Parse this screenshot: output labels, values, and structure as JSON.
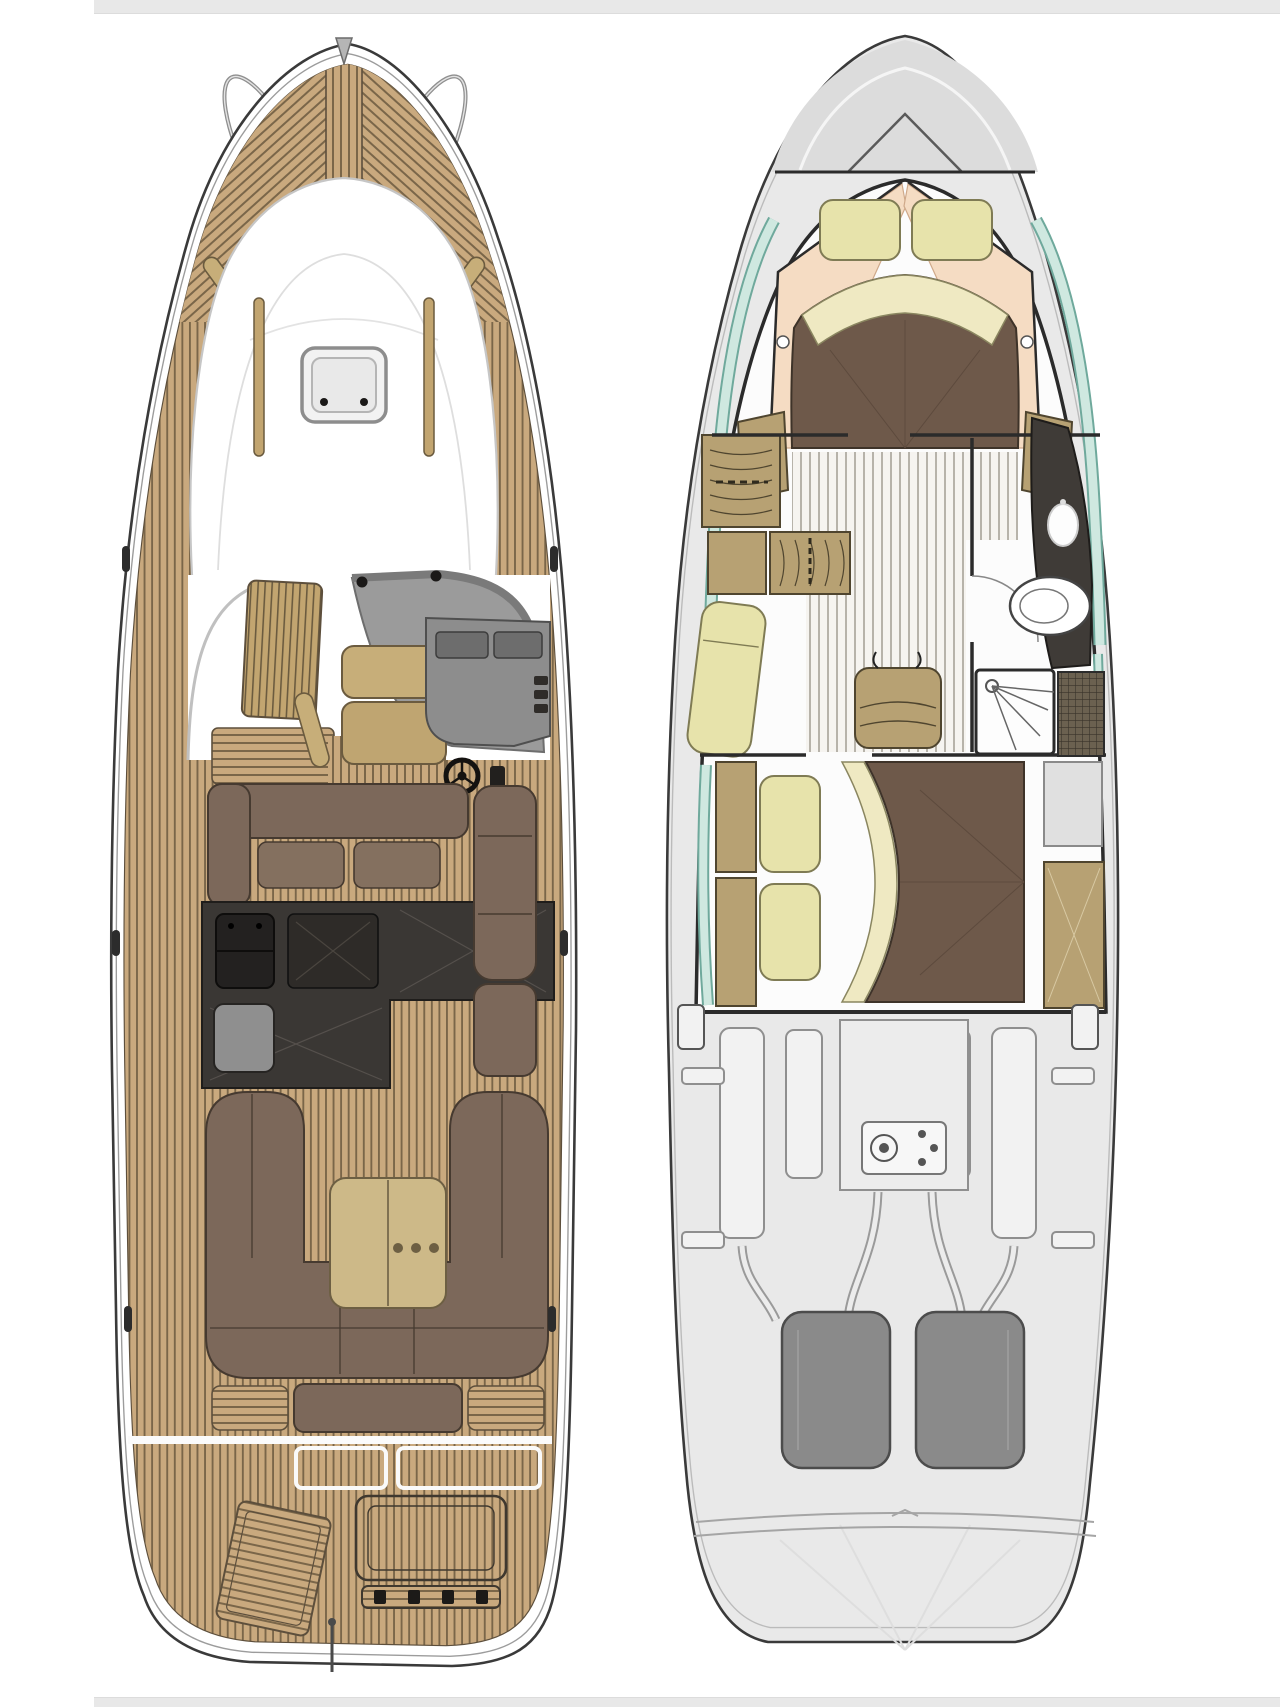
{
  "canvas": {
    "width": 1280,
    "height": 1707
  },
  "plans": [
    {
      "key": "main_deck",
      "semantic": "main-deck-floorplan",
      "features": [
        "bow-pulpit",
        "foredeck-sunpad",
        "roof-hatch",
        "windshield",
        "helm-console",
        "helm-seat",
        "salon-sofa",
        "galley",
        "cockpit-settee",
        "cockpit-table",
        "aft-sunpad",
        "swim-platform",
        "engine-hatch",
        "flag-pole"
      ]
    },
    {
      "key": "lower_deck",
      "semantic": "lower-deck-floorplan",
      "features": [
        "v-berth-bed",
        "pillows",
        "hull-windows",
        "wardrobe-lockers",
        "chaise-longue",
        "head-toilet",
        "shower-stall",
        "vanity",
        "aft-cabin-bed",
        "engine-room",
        "port-engine",
        "starboard-engine",
        "genset",
        "swim-platform"
      ]
    }
  ],
  "palette": {
    "page_bg": "#ffffff",
    "strip": "#e8e8e8",
    "outline": "#3a3a3a",
    "hull_inner_line": "#9c9c9c",
    "teak": "#c9a97e",
    "teak_line": "#7a6649",
    "teak_border": "#5d4f3c",
    "white_deck": "#ffffff",
    "deck_line": "#c6c6c6",
    "glass": "#9b9b9b",
    "glass_edge": "#6e6e6e",
    "windshield": "#7a7a7a",
    "black_dot": "#1b1918",
    "locker_tan": "#c2a570",
    "seat_tan": "#c7ae79",
    "seat_tan_dark": "#bfa571",
    "console": "#8d8d8d",
    "console_panel": "#6d6d6d",
    "console_detail": "#2f2c29",
    "brown": "#7c685a",
    "brown_dark": "#463a30",
    "brown_light": "#84705f",
    "galley": "#3a3734",
    "galley_edge": "#1f1d1b",
    "sink": "#232120",
    "appliance": "#8f8f8f",
    "table": "#cdb988",
    "table_line": "#6d5f43",
    "hull_gray": "#e9e9e9",
    "deck_gray": "#dcdcdc",
    "wall": "#2b2b2b",
    "interior_white": "#fcfcfc",
    "floor_bg": "#f6f4f0",
    "floor_line": "#b7b3aa",
    "window_teal": "#cfe8e0",
    "window_edge": "#6fa99c",
    "peach": "#f5dcc3",
    "peach_edge": "#cfa98a",
    "bed_brown": "#6e594a",
    "bed_dark": "#3e3329",
    "bed_seam": "#5d4a3d",
    "pillow": "#e7e3ab",
    "pillow_edge": "#7f7b54",
    "cream": "#efe9c2",
    "cream_edge": "#8a8660",
    "cabinet": "#b7a173",
    "cabinet_edge": "#4f452f",
    "vanity": "#3f3b37",
    "mosaic": "#6b6150",
    "mosaic_line": "#39332a",
    "machine_fill": "#f2f2f2",
    "machine_line": "#8f8f8f",
    "machine_panel": "#ececec",
    "engine": "#8a8a8a",
    "engine_edge": "#4c4c4c",
    "transom_line": "#a5a5a5",
    "ray": "#dedede"
  }
}
